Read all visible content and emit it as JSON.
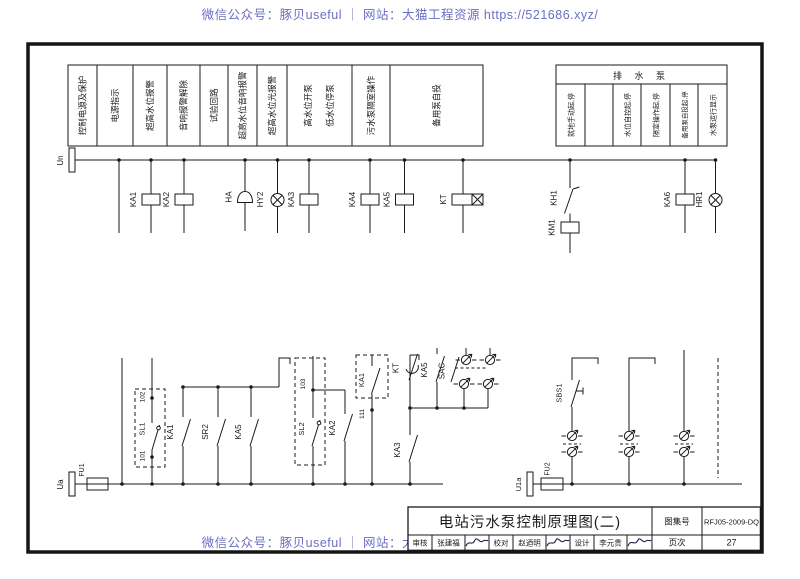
{
  "colors": {
    "ink": "#1a1a1a",
    "watermark": "#6b6fc4",
    "paper": "#ffffff"
  },
  "watermark": {
    "text": "微信公众号：豚贝useful ｜ 网站：大猫工程资源 https://521686.xyz/"
  },
  "function_labels": {
    "items": [
      "控制电源及保护",
      "电源指示",
      "超高水位报警",
      "音响报警解除",
      "试验回路",
      "超高水位音响报警",
      "超高水位光报警",
      "高水位开泵",
      "低水位停泵",
      "污水泵隔室操作",
      "备用泵自投"
    ]
  },
  "pump_table": {
    "header": "排 水 泵",
    "columns": [
      "就地手动起,停",
      "",
      "水位自控起,停",
      "隔室操作起,停",
      "备用泵自投起,停",
      "水泵运行显示"
    ]
  },
  "circuit": {
    "bus_top": "Un",
    "bus_bottom_left": "Ua",
    "bus_bottom_right": "U1a",
    "top_row": {
      "ka1": "KA1",
      "ka2": "KA2",
      "ha": "HA",
      "hy2": "HY2",
      "ka3": "KA3",
      "ka4": "KA4",
      "ka5": "KA5",
      "kt": "KT",
      "kh1": "KH1",
      "km1": "KM1",
      "ka6": "KA6",
      "hr1": "HR1"
    },
    "bottom_row": {
      "fu1": "FU1",
      "t101": "101",
      "sl1": "SL1",
      "t102": "102",
      "ka1": "KA1",
      "sr2": "SR2",
      "ka5": "KA5",
      "t103": "103",
      "sl2": "SL2",
      "ka2": "KA2",
      "ka1_box": "KA1",
      "t111": "111",
      "kt": "KT",
      "ka3": "KA3",
      "ka5b": "KA5",
      "sac": "SAC",
      "sbs1": "SBS1",
      "fu2": "FU2"
    }
  },
  "title_block": {
    "title": "电站污水泵控制原理图(二)",
    "atlas_label": "图集号",
    "atlas_no": "RFJ05-2009-DQ",
    "page_label": "页次",
    "page_no": "27",
    "approvals": [
      {
        "label": "审核",
        "name": "张建福"
      },
      {
        "label": "校对",
        "name": "赵迺明"
      },
      {
        "label": "设计",
        "name": "李元贵"
      }
    ]
  }
}
